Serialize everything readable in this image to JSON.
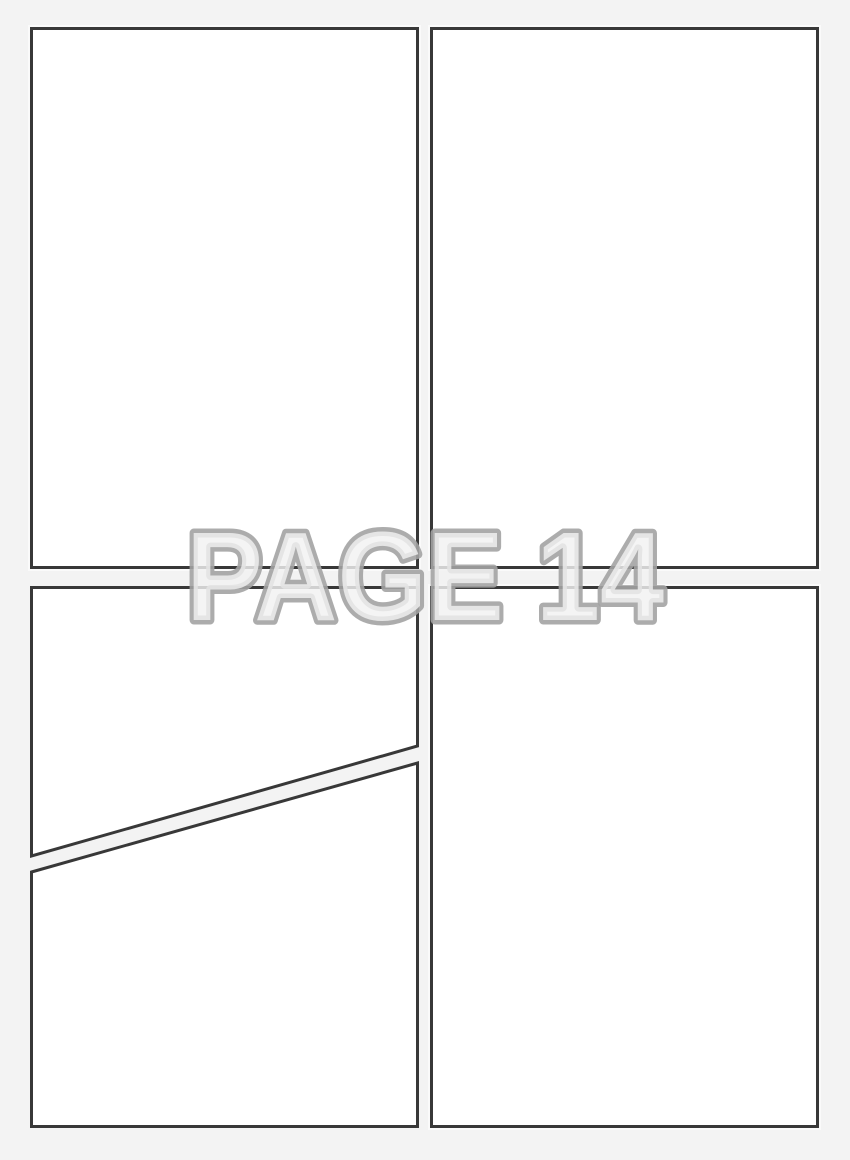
{
  "watermark": {
    "label": "PAGE 14"
  },
  "panels": [
    {
      "id": "top-left",
      "content": ""
    },
    {
      "id": "top-right",
      "content": ""
    },
    {
      "id": "bottom-left-upper",
      "content": ""
    },
    {
      "id": "bottom-left-lower",
      "content": ""
    },
    {
      "id": "bottom-right",
      "content": ""
    }
  ],
  "colors": {
    "background": "#f3f3f3",
    "panel_fill": "#ffffff",
    "panel_border": "#383838",
    "watermark_stroke": "#a3a3a3",
    "watermark_fill": "#f2f2f2"
  }
}
